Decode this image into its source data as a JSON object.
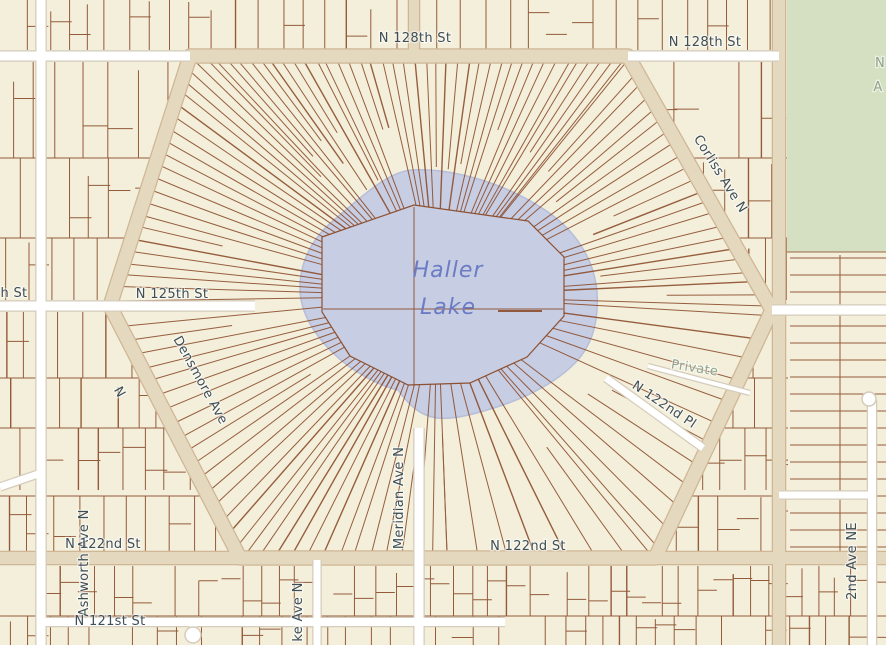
{
  "map": {
    "type": "parcel-map",
    "colors": {
      "background": "#f3efdb",
      "parcel_line": "#8a4a28",
      "road_tan_fill": "#e4d8bf",
      "road_tan_casing": "#cfb694",
      "road_white_fill": "#ffffff",
      "road_white_casing": "#d5ccbb",
      "water_fill": "#c7cde3",
      "water_edge": "#b6bed9",
      "park_fill": "#d5e0c3",
      "label_color": "#3e4e55",
      "water_label_color": "#6b7cc4",
      "minor_label_color": "#92a48d"
    },
    "water_label": {
      "line1": "Haller",
      "line2": "Lake"
    },
    "street_labels": [
      {
        "name": "n-128th-st-west",
        "text": "N 128th St",
        "x": 415,
        "y": 42,
        "rotate": 0
      },
      {
        "name": "n-128th-st-east",
        "text": "N 128th St",
        "x": 705,
        "y": 46,
        "rotate": 0
      },
      {
        "name": "corliss-ave-n",
        "text": "Corliss Ave N",
        "x": 717,
        "y": 176,
        "rotate": 58
      },
      {
        "name": "n-125th-st-partial",
        "text": "h St",
        "x": 14,
        "y": 297,
        "rotate": 0
      },
      {
        "name": "n-125th-st",
        "text": "N 125th St",
        "x": 172,
        "y": 298,
        "rotate": 0
      },
      {
        "name": "densmore-ave",
        "text": "Densmore Ave",
        "x": 197,
        "y": 382,
        "rotate": 61
      },
      {
        "name": "densmore-ave-n",
        "text": "N",
        "x": 116,
        "y": 394,
        "rotate": 61
      },
      {
        "name": "meridian-ave-n",
        "text": "Meridian Ave N",
        "x": 403,
        "y": 498,
        "rotate": -90
      },
      {
        "name": "ashworth-ave-n",
        "text": "Ashworth Ave N",
        "x": 88,
        "y": 563,
        "rotate": -90
      },
      {
        "name": "n-122nd-st-west",
        "text": "N 122nd St",
        "x": 103,
        "y": 548,
        "rotate": 0
      },
      {
        "name": "n-122nd-st-center",
        "text": "N 122nd St",
        "x": 528,
        "y": 550,
        "rotate": 0
      },
      {
        "name": "n-121st-st",
        "text": "N 121st St",
        "x": 110,
        "y": 625,
        "rotate": 0
      },
      {
        "name": "n-122nd-pl",
        "text": "N 122nd Pl",
        "x": 662,
        "y": 408,
        "rotate": 34
      },
      {
        "name": "burke-ave-n-partial",
        "text": "ke Ave N",
        "x": 302,
        "y": 612,
        "rotate": -90
      },
      {
        "name": "2nd-ave-ne",
        "text": "2nd Ave NE",
        "x": 856,
        "y": 561,
        "rotate": -90
      },
      {
        "name": "private-lane",
        "text": "Private",
        "x": 694,
        "y": 372,
        "rotate": 9,
        "color": "minor"
      },
      {
        "name": "park-label-frag-1",
        "text": "N",
        "x": 880,
        "y": 67,
        "rotate": 0,
        "color": "minor"
      },
      {
        "name": "park-label-frag-2",
        "text": "A",
        "x": 878,
        "y": 91,
        "rotate": 0,
        "color": "minor"
      }
    ],
    "roads": {
      "tan": [
        {
          "name": "ring-road",
          "points": [
            [
              190,
              56
            ],
            [
              628,
              56
            ],
            [
              772,
              310
            ],
            [
              655,
              558
            ],
            [
              240,
              558
            ],
            [
              110,
              306
            ]
          ],
          "closed": true,
          "width": 13
        },
        {
          "name": "1st-ave-ne",
          "points": [
            [
              779,
              0
            ],
            [
              779,
              645
            ]
          ],
          "width": 12
        },
        {
          "name": "meridian-ave-n-north",
          "points": [
            [
              414,
              0
            ],
            [
              414,
              52
            ]
          ],
          "width": 10
        },
        {
          "name": "n-122nd-st-west-ext",
          "points": [
            [
              0,
              558
            ],
            [
              240,
              558
            ]
          ],
          "width": 12
        },
        {
          "name": "n-122nd-st-east-ext",
          "points": [
            [
              655,
              558
            ],
            [
              886,
              558
            ]
          ],
          "width": 12
        }
      ],
      "white": [
        {
          "name": "n-128th-st-west",
          "points": [
            [
              0,
              56
            ],
            [
              190,
              56
            ]
          ],
          "width": 9
        },
        {
          "name": "n-128th-st-east",
          "points": [
            [
              628,
              56
            ],
            [
              779,
              56
            ]
          ],
          "width": 9
        },
        {
          "name": "ashworth-ave-n",
          "points": [
            [
              41,
              0
            ],
            [
              41,
              645
            ]
          ],
          "width": 9
        },
        {
          "name": "n-125th-st-west",
          "points": [
            [
              0,
              306
            ],
            [
              255,
              306
            ]
          ],
          "width": 9
        },
        {
          "name": "n-125th-st-east",
          "points": [
            [
              772,
              310
            ],
            [
              886,
              310
            ]
          ],
          "width": 9
        },
        {
          "name": "meridian-ave-n-south",
          "points": [
            [
              419,
              428
            ],
            [
              419,
              645
            ]
          ],
          "width": 9
        },
        {
          "name": "burke-ave-n",
          "points": [
            [
              317,
              560
            ],
            [
              317,
              645
            ]
          ],
          "width": 7
        },
        {
          "name": "n-121st-st",
          "points": [
            [
              41,
              622
            ],
            [
              505,
              622
            ]
          ],
          "width": 8
        },
        {
          "name": "n-122nd-pl",
          "points": [
            [
              606,
              378
            ],
            [
              703,
              448
            ]
          ],
          "width": 7
        },
        {
          "name": "2nd-ave-ne",
          "points": [
            [
              872,
              400
            ],
            [
              872,
              645
            ]
          ],
          "width": 8
        },
        {
          "name": "cross-street-east",
          "points": [
            [
              779,
              495
            ],
            [
              872,
              495
            ]
          ],
          "width": 7
        },
        {
          "name": "private-lane",
          "points": [
            [
              648,
              366
            ],
            [
              750,
              393
            ]
          ],
          "width": 4
        },
        {
          "name": "sw-diagonal-stub",
          "points": [
            [
              0,
              487
            ],
            [
              41,
              473
            ]
          ],
          "width": 7
        },
        {
          "name": "cul-de-sac-stub",
          "points": [
            [
              193,
              622
            ],
            [
              193,
              632
            ]
          ],
          "width": 7
        }
      ],
      "cul_de_sacs": [
        [
          193,
          635,
          8
        ],
        [
          869,
          399,
          7
        ]
      ]
    },
    "hexagon": [
      [
        190,
        56
      ],
      [
        628,
        56
      ],
      [
        772,
        310
      ],
      [
        655,
        558
      ],
      [
        240,
        558
      ],
      [
        110,
        306
      ]
    ],
    "lake_parcel_polygon": [
      [
        322,
        237
      ],
      [
        414,
        205
      ],
      [
        528,
        221
      ],
      [
        564,
        257
      ],
      [
        564,
        316
      ],
      [
        527,
        357
      ],
      [
        470,
        383
      ],
      [
        408,
        385
      ],
      [
        350,
        356
      ],
      [
        322,
        312
      ]
    ],
    "park": {
      "x": 787,
      "y": 0,
      "w": 99,
      "h": 252
    }
  }
}
